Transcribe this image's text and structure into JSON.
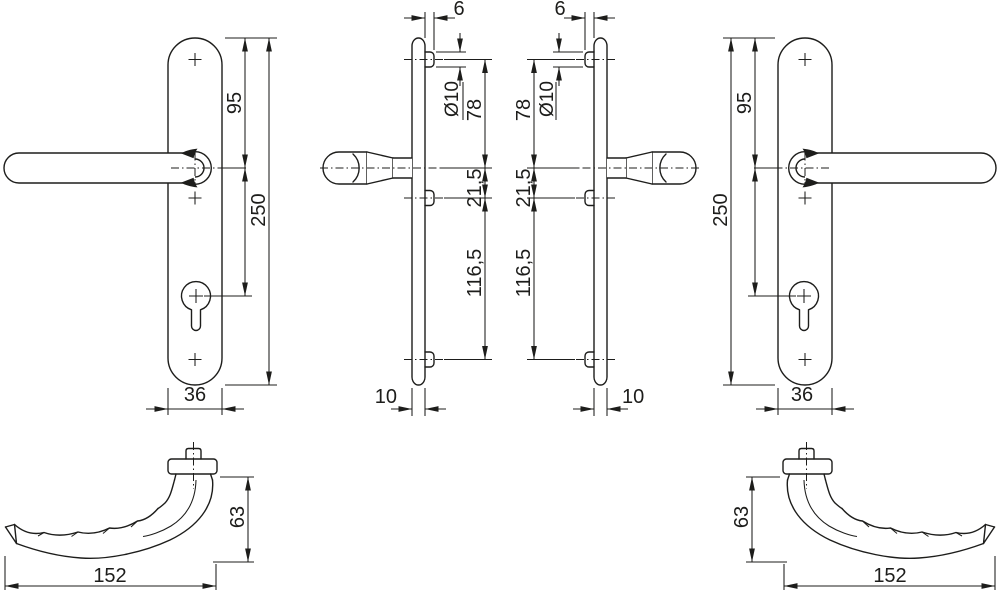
{
  "drawing": {
    "type": "technical-drawing-door-handle",
    "dims": {
      "plate_length": "250",
      "top_to_handle": "95",
      "plate_width": "36",
      "pin_projection": "6",
      "pin_diameter": "Ø10",
      "pin_to_handle": "78",
      "handle_to_pin2": "21,5",
      "pin2_to_pin3": "116,5",
      "plate_thickness": "10",
      "handle_depth": "63",
      "handle_length": "152"
    },
    "colors": {
      "line": "#1d1d1b",
      "background": "#ffffff"
    }
  }
}
